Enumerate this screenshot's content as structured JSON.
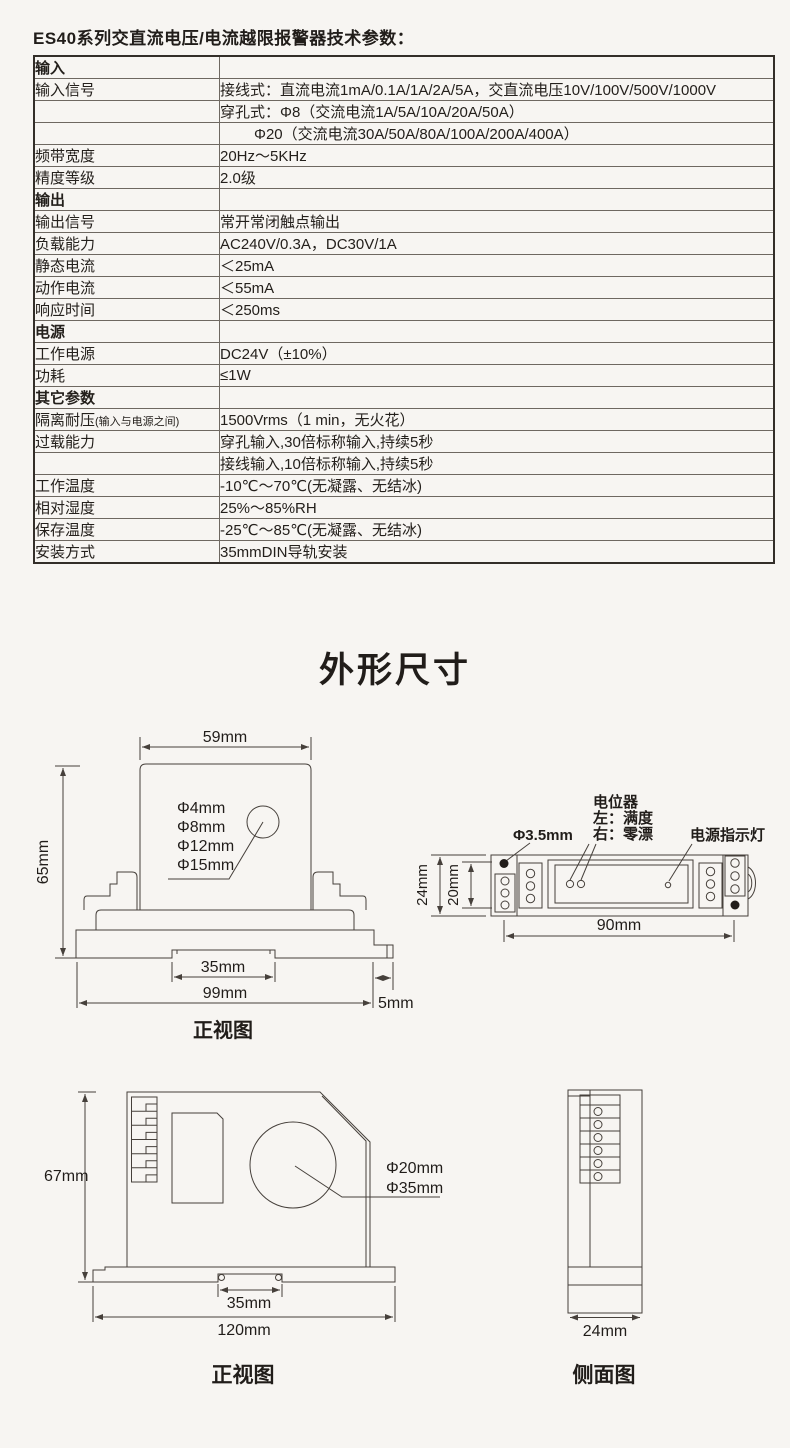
{
  "doc_title": "ES40系列交直流电压/电流越限报警器技术参数：",
  "spec_table": {
    "rows": [
      {
        "label": "输入",
        "value": ""
      },
      {
        "label": "输入信号",
        "value": "接线式：直流电流1mA/0.1A/1A/2A/5A，交直流电压10V/100V/500V/1000V"
      },
      {
        "label": "",
        "value": "穿孔式：Φ8（交流电流1A/5A/10A/20A/50A）"
      },
      {
        "label": "",
        "value": "Φ20（交流电流30A/50A/80A/100A/200A/400A）"
      },
      {
        "label": "频带宽度",
        "value": "20Hz～5KHz"
      },
      {
        "label": "精度等级",
        "value": "2.0级"
      },
      {
        "label": "输出",
        "value": ""
      },
      {
        "label": "输出信号",
        "value": "常开常闭触点输出"
      },
      {
        "label": "负载能力",
        "value": "AC240V/0.3A，DC30V/1A"
      },
      {
        "label": "静态电流",
        "value": "＜25mA"
      },
      {
        "label": "动作电流",
        "value": "＜55mA"
      },
      {
        "label": "响应时间",
        "value": "＜250ms"
      },
      {
        "label": "电源",
        "value": ""
      },
      {
        "label": "工作电源",
        "value": "DC24V（±10%）"
      },
      {
        "label": "功耗",
        "value": "≤1W"
      },
      {
        "label": "其它参数",
        "value": ""
      },
      {
        "label": "隔离耐压",
        "label_small": "(输入与电源之间)",
        "value": "1500Vrms（1 min，无火花）"
      },
      {
        "label": "过载能力",
        "value": "穿孔输入,30倍标称输入,持续5秒"
      },
      {
        "label": "",
        "value": "接线输入,10倍标称输入,持续5秒"
      },
      {
        "label": "工作温度",
        "value": "-10℃～70℃(无凝露、无结冰)"
      },
      {
        "label": "相对湿度",
        "value": "25%～85%RH"
      },
      {
        "label": "保存温度",
        "value": "-25℃～85℃(无凝露、无结冰)"
      },
      {
        "label": "安装方式",
        "value": "35mmDIN导轨安装"
      }
    ]
  },
  "section_title": "外形尺寸",
  "front_view_small": {
    "width_dim": "59mm",
    "height_dim": "65mm",
    "hole_labels": [
      "Φ4mm",
      "Φ8mm",
      "Φ12mm",
      "Φ15mm"
    ],
    "din_dim": "35mm",
    "base_dim": "99mm",
    "latch_dim": "5mm",
    "caption": "正视图"
  },
  "top_view": {
    "pot_label": "电位器",
    "pot_left_label": "左：满度",
    "pot_right_label": "右：零漂",
    "led_label": "电源指示灯",
    "hole_label": "Φ3.5mm",
    "width_dim": "24mm",
    "inner_dim": "20mm",
    "length_dim": "90mm"
  },
  "front_view_large": {
    "height_dim": "67mm",
    "hole_labels": [
      "Φ20mm",
      "Φ35mm"
    ],
    "din_dim": "35mm",
    "width_dim": "120mm",
    "caption": "正视图"
  },
  "side_view": {
    "width_dim": "24mm",
    "caption": "侧面图"
  }
}
